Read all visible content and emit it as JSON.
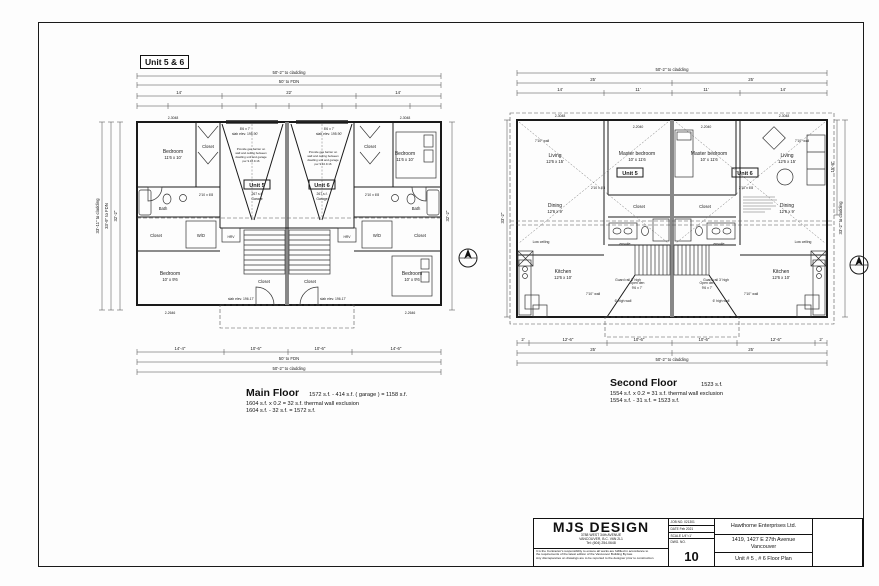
{
  "sheet": {
    "badge": "Unit 5 & 6"
  },
  "main_floor": {
    "title": "Main Floor",
    "calc1": "1572 s.f. - 414 s.f. ( garage ) = 1158 s.f.",
    "calc2": "1604 s.f. x 0.2 = 32 s.f. thermal wall exclusion",
    "calc3": "1604 s.f. - 32 s.f. = 1572 s.f.",
    "unit5": "Unit 5",
    "unit6": "Unit 6",
    "garage_sf": "267 s.f.",
    "garage_word": "Garage",
    "rooms": {
      "bedroom": "Bedroom",
      "bedroom1_size": "11'6 x 10'",
      "bedroom2_size": "10' x 9'6",
      "bath": "Bath",
      "closet": "Closet",
      "wd": "W/D",
      "hrv": "HRV"
    },
    "notes": {
      "garage_door": "8'6 x 7'",
      "slab_garage": "slab elev. 195.90'",
      "slab_entry": "slab elev. 196.17'",
      "gas": [
        "Provide gas barrier on",
        "wall and ceiling between",
        "dwelling unit and garage",
        "per 9.10.9.16"
      ]
    },
    "tags": {
      "win_top": "2-3048",
      "win_bottom": "2-2646",
      "door": "2'10 x 6'8"
    },
    "dims": {
      "top1": "50'-2\"  to cladding",
      "top2": "50'  to FDN",
      "top3": [
        "14'",
        "22'",
        "14'"
      ],
      "bottom1": [
        "14'-4\"",
        "10'-6\"",
        "10'-6\"",
        "14'-6\""
      ],
      "bottom2": "50'  to FDN",
      "bottom3": "50'-2\"  to cladding",
      "left": [
        "33'-11\" to cladding",
        "33'-9\" to FDN",
        "32'-2\""
      ],
      "right": "32'-2\""
    }
  },
  "second_floor": {
    "title": "Second Floor",
    "area": "1523 s.f.",
    "calc2": "1554 s.f. x 0.2 = 31 s.f. thermal wall exclusion",
    "calc3": "1554 s.f. - 31 s.f. = 1523 s.f.",
    "unit5": "Unit 5",
    "unit6": "Unit 6",
    "rooms": {
      "living": "Living",
      "living_size": "12'6 x 15'",
      "dining": "Dining",
      "dining_size": "12'6 x 9'",
      "kitchen": "Kitchen",
      "kitchen_size": "12'6 x 10'",
      "master": "Master bedroom",
      "master_size": "10' x 11'6",
      "closet": "Closet",
      "ensuite": "ensuite",
      "open_den": "Open den",
      "open_den_size": "9'6 x 7'"
    },
    "notes": {
      "guard": "Guard rail 3' high",
      "high_wall": "6' high wall",
      "wall710": "7'10\" wall",
      "low_ceiling": "Low ceiling"
    },
    "tags": {
      "win": "2-3048",
      "win2": "2-2040",
      "door": "2'10 x 6'8"
    },
    "dims": {
      "top1": "50'-2\"  to cladding",
      "top2": [
        "25'",
        "25'"
      ],
      "top3": [
        "14'",
        "11'",
        "11'",
        "14'"
      ],
      "bottom1": [
        "2'",
        "12'-6\"",
        "10'-6\"",
        "10'-6\"",
        "12'-6\"",
        "2'"
      ],
      "bottom2": [
        "25'",
        "25'"
      ],
      "bottom3": "50'-2\"  to cladding",
      "right1": "15'-8\"",
      "right2": "33'-2\" to cladding",
      "left1": "33'-2\""
    }
  },
  "title_block": {
    "firm": {
      "name": "MJS DESIGN",
      "addr1": "3788 WEST 34th AVENUE",
      "addr2": "VANCOUVER, B.C. V6N 2L1",
      "addr3": "Tel: (604) 254-0648"
    },
    "disclaimer": [
      "It is the Contractor's responsibility to ensure all works are fulfilled in accordance to",
      "the requirements of the latest edition of the Vancouver Building By-law.",
      "Any discrepancies on drawings are to be reported to the designer prior to construction"
    ],
    "job_label": "JOB NO.",
    "job": "021301",
    "date_label": "DATE",
    "date": "Feb 2021",
    "scale_label": "SCALE",
    "scale": "1/4\"=1'",
    "dwg_label": "DWG. NO.",
    "dwg": "10",
    "client": "Hawthorne Enterprises Ltd.",
    "project1": "1419, 1427  E 27th Avenue",
    "project2": "Vancouver",
    "sheet_title": "Unit # 5 , # 6 Floor Plan"
  }
}
